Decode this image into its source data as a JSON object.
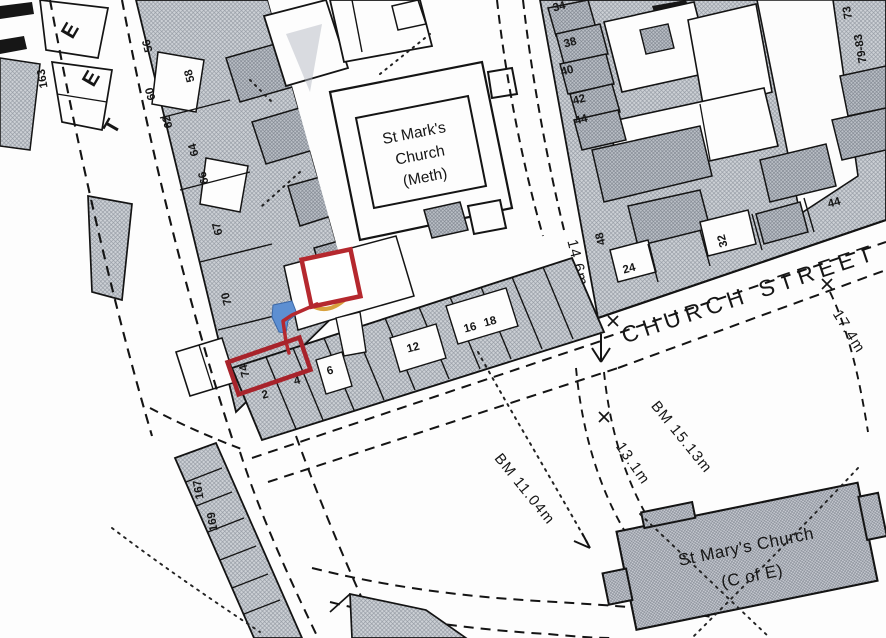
{
  "streets": {
    "west_street_letters": [
      "E",
      "E",
      "T"
    ],
    "church_street": "CHURCH STREET"
  },
  "churches": {
    "st_marks": [
      "St Mark's",
      "Church",
      "(Meth)"
    ],
    "st_marys": [
      "St Mary's Church",
      "(C of E)"
    ]
  },
  "measurements": {
    "junction_width": "14.6m",
    "east_width": "17.4m",
    "benchmark_east": "BM 15.13m",
    "spot_height": "13.1m",
    "benchmark_south": "BM 11.04m"
  },
  "house_numbers": {
    "west_street": [
      "163",
      "56",
      "58",
      "60",
      "62",
      "64",
      "66",
      "67",
      "70",
      "74",
      "167",
      "169"
    ],
    "north_terrace": [
      "34",
      "38",
      "40",
      "42",
      "44"
    ],
    "church_street_north": [
      "48",
      "24",
      "32",
      "44"
    ],
    "church_street_south": [
      "2",
      "4",
      "6",
      "12",
      "16",
      "18"
    ],
    "east_street": [
      "73",
      "79-83"
    ]
  },
  "overlay": {
    "boundary_color": "#b5282e",
    "water_color": "#5d8fd2",
    "route_color": "#d5992c"
  }
}
